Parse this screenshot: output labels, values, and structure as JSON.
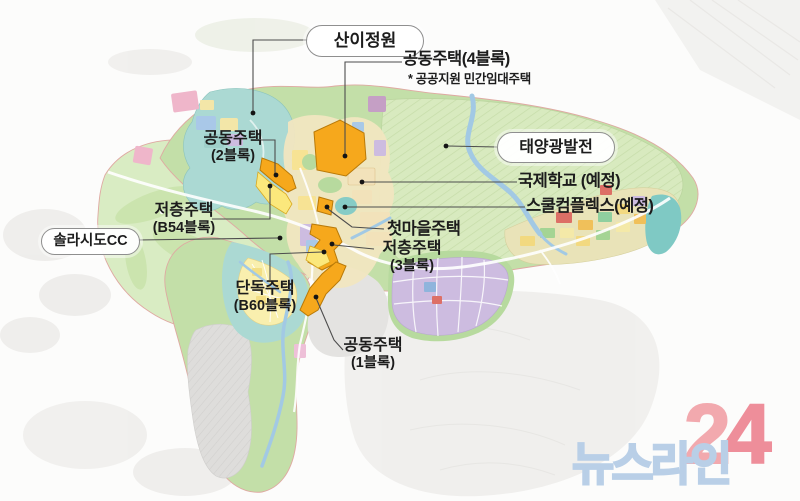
{
  "callouts": {
    "saniGarden": {
      "label": "산이정원"
    },
    "apt4": {
      "label": "공동주택(4블록)",
      "note": "* 공공지원 민간임대주택"
    },
    "solar": {
      "label": "태양광발전"
    },
    "intlSchool": {
      "label": "국제학교 (예정)"
    },
    "schoolComplex": {
      "label": "스쿨컴플렉스(예정)"
    },
    "apt2": {
      "line1": "공동주택",
      "line2": "(2블록)"
    },
    "lowriseB54": {
      "line1": "저층주택",
      "line2": "(B54블록)"
    },
    "solaseadoCC": {
      "label": "솔라시도CC"
    },
    "firstVillage": {
      "label": "첫마을주택"
    },
    "lowrise3": {
      "line1": "저층주택",
      "line2": "(3블록)"
    },
    "singleB60": {
      "line1": "단독주택",
      "line2": "(B60블록)"
    },
    "apt1": {
      "line1": "공동주택",
      "line2": "(1블록)"
    }
  },
  "watermark": {
    "name": "뉴스라인",
    "digit_2": "2",
    "digit_4": "4"
  },
  "colors": {
    "orange": "#f6a81c",
    "yellow_parcel": "#fbe87c",
    "site_green": "#c3dfa8",
    "golf_green": "#d9ecc3",
    "solar_green": "#d8eabf",
    "teal": "#abd9d3",
    "lavender": "#cdbce0",
    "cream": "#f2e2ba",
    "river_blue": "#a2c9e4",
    "gray_hill": "#dddcda",
    "boundary_pink": "#dfa9a2",
    "label_ink": "#1c1c1c",
    "watermark_blue": "#b9cfe7",
    "watermark_pink": "#f2a9ae",
    "watermark_red": "#ee8e9a"
  }
}
